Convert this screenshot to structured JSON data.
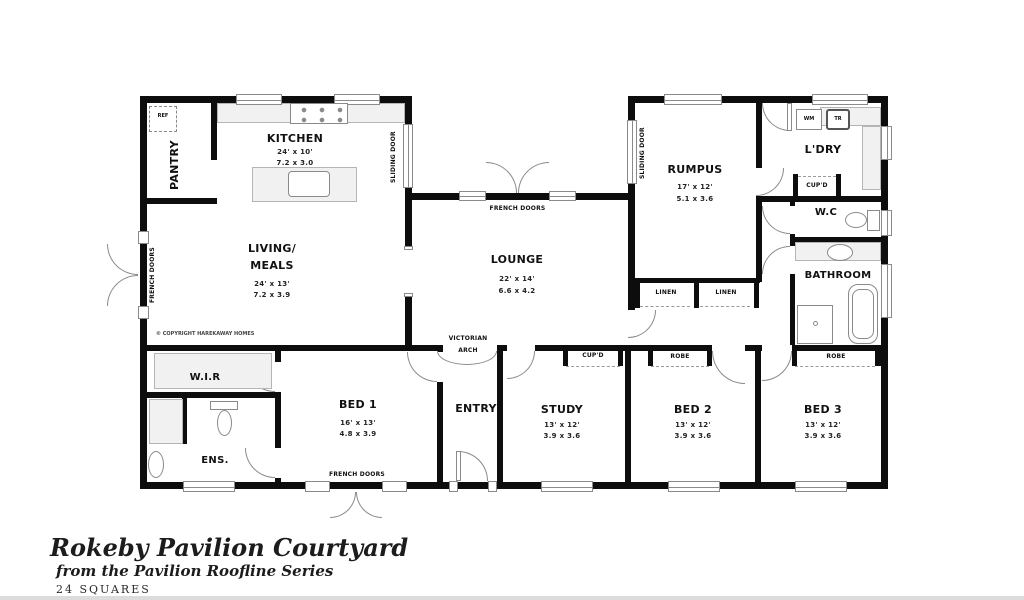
{
  "title_block": {
    "title": "Rokeby Pavilion Courtyard",
    "subtitle": "from the Pavilion Roofline Series",
    "size_label": "24 SQUARES"
  },
  "copyright_note": "© COPYRIGHT HAREKAWAY HOMES",
  "rooms": {
    "kitchen": {
      "name": "KITCHEN",
      "imperial": "24' x 10'",
      "metric": "7.2 x 3.0"
    },
    "pantry": {
      "name": "PANTRY"
    },
    "living_meals": {
      "line1": "LIVING/",
      "line2": "MEALS",
      "imperial": "24' x 13'",
      "metric": "7.2 x 3.9"
    },
    "lounge": {
      "name": "LOUNGE",
      "imperial": "22' x 14'",
      "metric": "6.6 x 4.2"
    },
    "rumpus": {
      "name": "RUMPUS",
      "imperial": "17' x 12'",
      "metric": "5.1 x 3.6"
    },
    "laundry": {
      "name": "L'DRY"
    },
    "wc": {
      "name": "W.C"
    },
    "bathroom": {
      "name": "BATHROOM"
    },
    "wir": {
      "name": "W.I.R"
    },
    "ensuite": {
      "name": "ENS."
    },
    "bed1": {
      "name": "BED 1",
      "imperial": "16' x 13'",
      "metric": "4.8 x 3.9"
    },
    "entry": {
      "name": "ENTRY"
    },
    "study": {
      "name": "STUDY",
      "imperial": "13' x 12'",
      "metric": "3.9 x 3.6"
    },
    "bed2": {
      "name": "BED 2",
      "imperial": "13' x 12'",
      "metric": "3.9 x 3.6"
    },
    "bed3": {
      "name": "BED 3",
      "imperial": "13' x 12'",
      "metric": "3.9 x 3.6"
    }
  },
  "labels": {
    "french_doors": "FRENCH DOORS",
    "sliding_door": "SLIDING DOOR",
    "victorian_arch_line1": "VICTORIAN",
    "victorian_arch_line2": "ARCH",
    "linen": "LINEN",
    "cupboard": "CUP'D",
    "robe": "ROBE",
    "fridge": "REF",
    "washing_machine": "WM",
    "trough": "TR"
  },
  "colors": {
    "wall": "#0d0d0d",
    "fixture_outline": "#8a8a8a",
    "bench_fill": "#f1f1f1"
  }
}
